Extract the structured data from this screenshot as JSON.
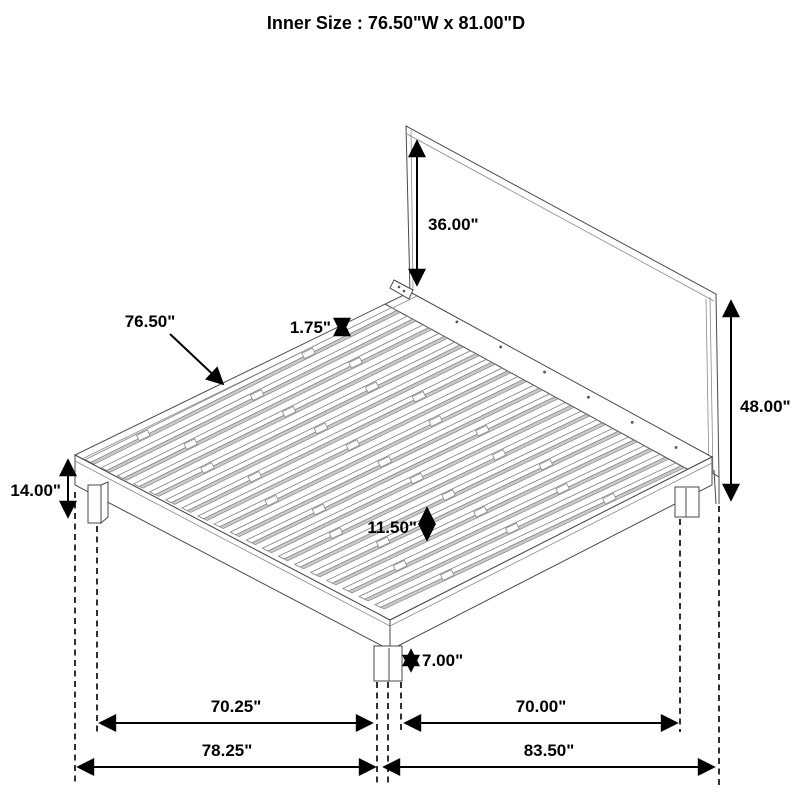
{
  "title": "Inner Size : 76.50\"W x 81.00\"D",
  "dims": {
    "headboard_above_deck": "36.00\"",
    "overall_height": "48.00\"",
    "slat_length": "76.50\"",
    "slat_thickness": "1.75\"",
    "under_clearance": "11.50\"",
    "platform_height": "14.00\"",
    "leg_height": "7.00\"",
    "span_left_inner": "70.25\"",
    "span_right_inner": "70.00\"",
    "span_left_outer": "78.25\"",
    "span_right_outer": "83.50\""
  }
}
